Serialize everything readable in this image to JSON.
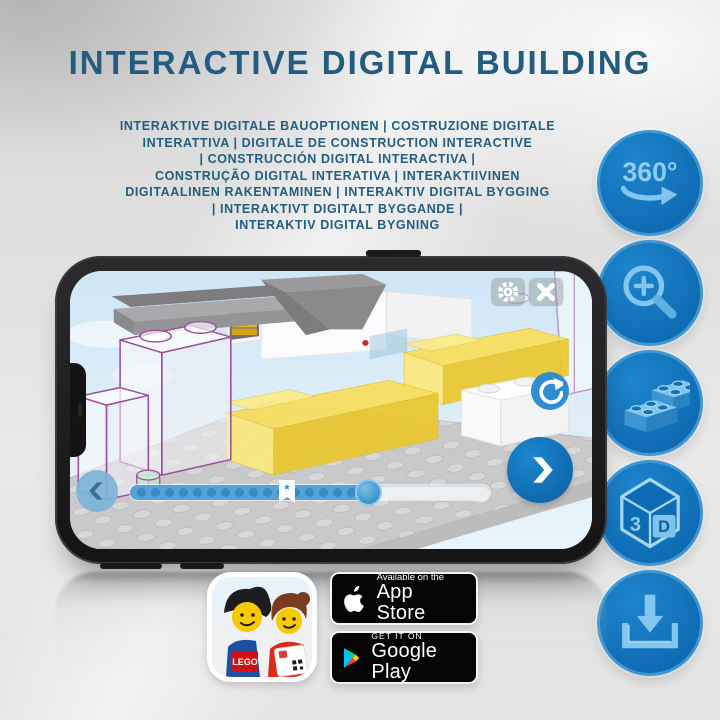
{
  "title": "INTERACTIVE DIGITAL BUILDING",
  "subtitle_lines": [
    "INTERAKTIVE DIGITALE BAUOPTIONEN | COSTRUZIONE DIGITALE",
    "INTERATTIVA | DIGITALE DE CONSTRUCTION INTERACTIVE",
    "| CONSTRUCCIÓN DIGITAL INTERACTIVA |",
    "CONSTRUÇÃO DIGITAL INTERATIVA | INTERAKTIIVINEN",
    "DIGITAALINEN RAKENTAMINEN | INTERAKTIV DIGITAL BYGGING",
    "| INTERAKTIVT DIGITALT BYGGANDE |",
    "INTERAKTIV DIGITAL BYGNING"
  ],
  "features": [
    {
      "name": "360-rotation-icon",
      "label": "360°"
    },
    {
      "name": "zoom-in-icon",
      "label": ""
    },
    {
      "name": "building-bricks-icon",
      "label": ""
    },
    {
      "name": "3d-view-icon",
      "cube_left": "3",
      "cube_right": "D"
    },
    {
      "name": "download-icon",
      "label": ""
    }
  ],
  "phone": {
    "progress": {
      "filled_fraction": 0.66,
      "bookmark_fraction": 0.436,
      "dot_count": 17
    }
  },
  "store": {
    "app_icon": {
      "logo_text": "LEGO"
    },
    "app_store": {
      "line1": "Available on the",
      "line2": "App Store"
    },
    "google_play": {
      "line1": "GET IT ON",
      "line2": "Google Play"
    }
  },
  "colors": {
    "title_blue": "#225c80",
    "feature_circle_blue": "#0f6cb4",
    "feature_glyph_blue": "#82c5ee",
    "screen_sky": "#cfe6f5",
    "brick_yellow": "#f5dc55",
    "ghost_outline_purple": "#9b4f9e",
    "progress_blue": "#54a2d6",
    "badge_black": "#040404"
  }
}
